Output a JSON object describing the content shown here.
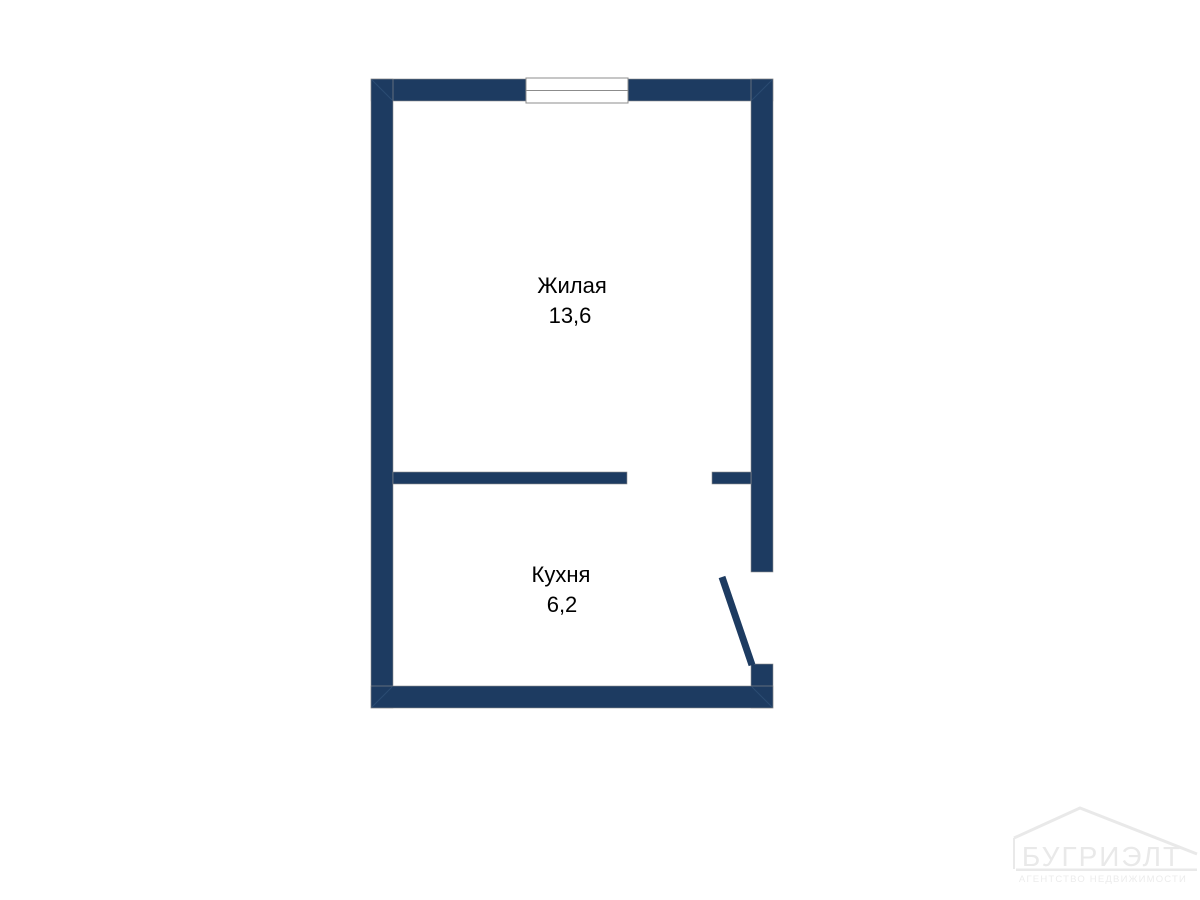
{
  "plan": {
    "rooms": [
      {
        "label": "Жилая",
        "area": "13,6"
      },
      {
        "label": "Кухня",
        "area": "6,2"
      }
    ]
  },
  "watermark": {
    "brand": "БУГРИЭЛТ",
    "tagline": "АГЕНТСТВО НЕДВИЖИМОСТИ"
  },
  "colors": {
    "wall": "#1d3b61",
    "wall_outline": "#8f8f8f",
    "window_frame": "#8c8c8c",
    "label_text": "#000000",
    "watermark": "#e9e9e9",
    "background": "#ffffff"
  }
}
